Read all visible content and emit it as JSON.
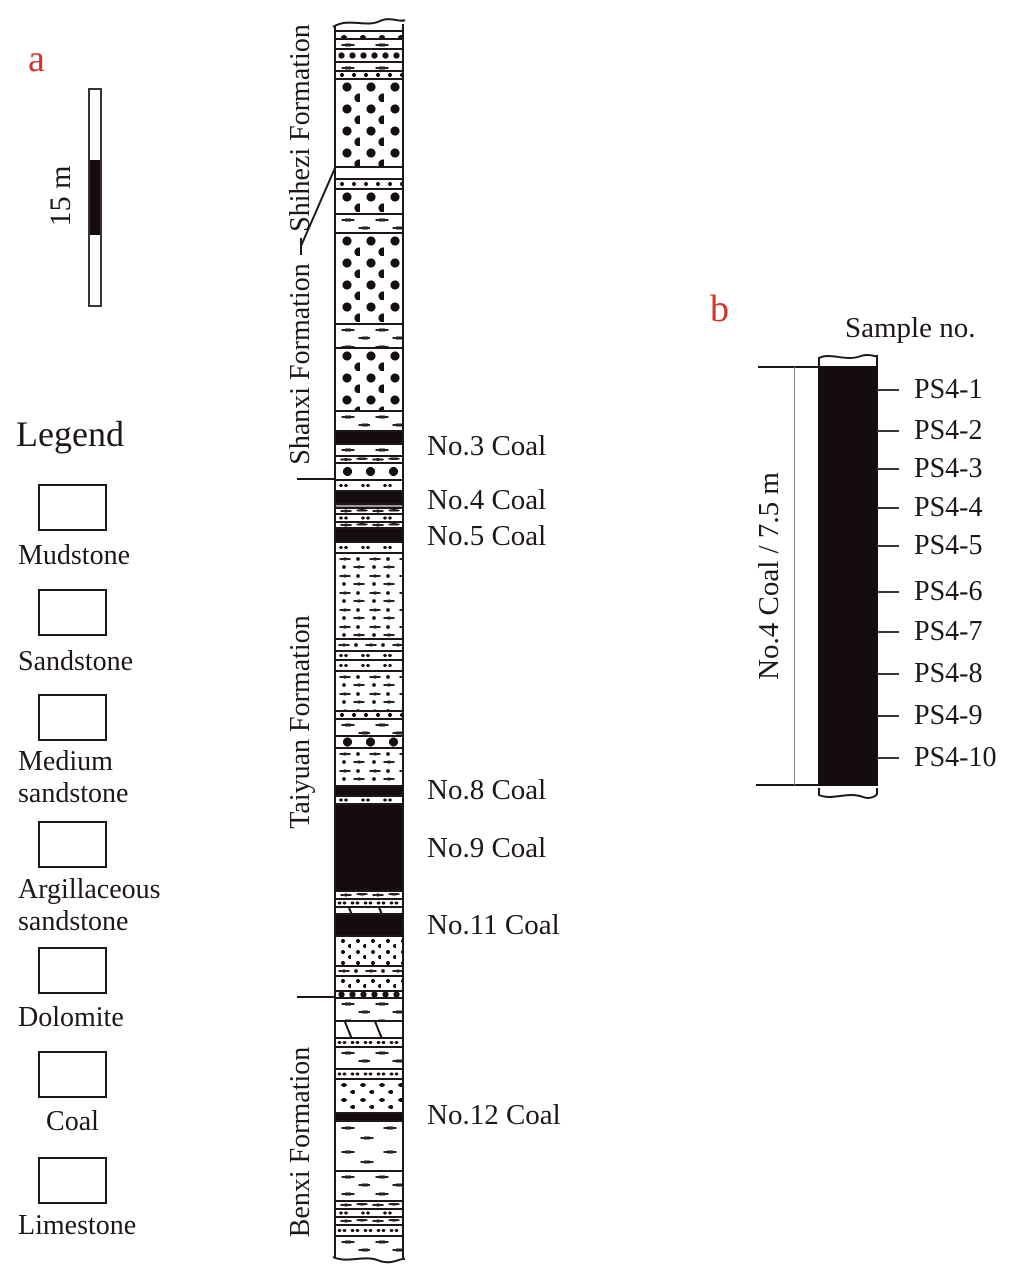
{
  "meta": {
    "ink_color": "#1f1717",
    "coal_color": "#150d0d",
    "accent_red": "#d5342b",
    "gray_band_color": "#9c9c9c"
  },
  "panel_a": {
    "label": "a",
    "scale": {
      "label": "15 m"
    },
    "legend": {
      "title": "Legend",
      "items": [
        {
          "name": "mudstone",
          "pattern": "mud",
          "lines": [
            "Mudstone"
          ],
          "box_y": 484,
          "label_y": 540
        },
        {
          "name": "sandstone",
          "pattern": "sand",
          "lines": [
            "Sandstone"
          ],
          "box_y": 589,
          "label_y": 646
        },
        {
          "name": "medium-sandstone",
          "pattern": "med",
          "lines": [
            "Medium",
            "sandstone"
          ],
          "box_y": 694,
          "label_y": 746
        },
        {
          "name": "argillaceous-sandstone",
          "pattern": "arg",
          "lines": [
            "Argillaceous",
            "sandstone"
          ],
          "box_y": 821,
          "label_y": 874
        },
        {
          "name": "dolomite",
          "pattern": "dolo-sw",
          "lines": [
            "Dolomite"
          ],
          "box_y": 947,
          "label_y": 1002
        },
        {
          "name": "coal",
          "pattern": "coal",
          "lines": [
            "Coal"
          ],
          "box_y": 1051,
          "label_y": 1106,
          "center": true
        },
        {
          "name": "limestone",
          "pattern": "lime",
          "lines": [
            "Limestone"
          ],
          "box_y": 1157,
          "label_y": 1210
        }
      ]
    }
  },
  "column": {
    "formations": [
      {
        "name": "Shihezi Formation",
        "cx": 301,
        "cy": 128,
        "len": 236
      },
      {
        "name": "Shanxi Formation",
        "cx": 301,
        "cy": 364,
        "len": 228
      },
      {
        "name": "Taiyuan Formation",
        "cx": 301,
        "cy": 722,
        "len": 256
      },
      {
        "name": "Benxi Formation",
        "cx": 301,
        "cy": 1142,
        "len": 250
      }
    ],
    "boundary_ticks_y": [
      478,
      996
    ],
    "layers": [
      {
        "p": "boxes",
        "h": 8
      },
      {
        "p": "mud",
        "h": 10
      },
      {
        "p": "dotrow",
        "h": 13
      },
      {
        "p": "mud",
        "h": 9
      },
      {
        "p": "med1",
        "h": 8
      },
      {
        "p": "sand",
        "h": 88
      },
      {
        "p": "blank",
        "h": 12
      },
      {
        "p": "med1",
        "h": 10
      },
      {
        "p": "sand",
        "h": 25
      },
      {
        "p": "mud",
        "h": 19
      },
      {
        "p": "sand",
        "h": 91
      },
      {
        "p": "mud",
        "h": 24
      },
      {
        "p": "sand",
        "h": 63
      },
      {
        "p": "mud",
        "h": 20
      },
      {
        "p": "coal",
        "h": 13
      },
      {
        "p": "mud",
        "h": 12
      },
      {
        "p": "mud-thin",
        "h": 7
      },
      {
        "p": "sand1",
        "h": 17
      },
      {
        "p": "oo",
        "h": 11
      },
      {
        "p": "coal",
        "h": 13
      },
      {
        "p": "gray",
        "h": 4
      },
      {
        "p": "mud-thin",
        "h": 6
      },
      {
        "p": "oo",
        "h": 8
      },
      {
        "p": "mud-thin",
        "h": 6
      },
      {
        "p": "coal",
        "h": 14
      },
      {
        "p": "oo",
        "h": 11
      },
      {
        "p": "arg",
        "h": 86
      },
      {
        "p": "arg-thin",
        "h": 12
      },
      {
        "p": "oo",
        "h": 9
      },
      {
        "p": "oo",
        "h": 11
      },
      {
        "p": "arg",
        "h": 40
      },
      {
        "p": "med1",
        "h": 8
      },
      {
        "p": "mud",
        "h": 17
      },
      {
        "p": "sand1",
        "h": 12
      },
      {
        "p": "arg",
        "h": 38
      },
      {
        "p": "coal",
        "h": 10
      },
      {
        "p": "oo",
        "h": 8
      },
      {
        "p": "coal",
        "h": 87
      },
      {
        "p": "mud-thin",
        "h": 8
      },
      {
        "p": "oo-dense",
        "h": 8
      },
      {
        "p": "dolo",
        "h": 7
      },
      {
        "p": "coal",
        "h": 22
      },
      {
        "p": "med",
        "h": 30
      },
      {
        "p": "arg-thin",
        "h": 10
      },
      {
        "p": "med",
        "h": 15
      },
      {
        "p": "dotrow",
        "h": 7
      },
      {
        "p": "mud",
        "h": 23
      },
      {
        "p": "dolo",
        "h": 17
      },
      {
        "p": "oo-dense",
        "h": 9
      },
      {
        "p": "mud",
        "h": 22
      },
      {
        "p": "oo-dense",
        "h": 10
      },
      {
        "p": "boxes",
        "h": 34
      },
      {
        "p": "coal",
        "h": 8
      },
      {
        "p": "mud-sparse",
        "h": 50
      },
      {
        "p": "mud",
        "h": 30
      },
      {
        "p": "mud-thin",
        "h": 8
      },
      {
        "p": "oo",
        "h": 8
      },
      {
        "p": "mud-thin",
        "h": 8
      },
      {
        "p": "oo-dense",
        "h": 11
      },
      {
        "p": "mud",
        "h": 21
      }
    ],
    "coal_labels": [
      {
        "text": "No.3 Coal",
        "y": 446
      },
      {
        "text": "No.4 Coal",
        "y": 500
      },
      {
        "text": "No.5 Coal",
        "y": 536
      },
      {
        "text": "No.8 Coal",
        "y": 790
      },
      {
        "text": "No.9 Coal",
        "y": 848
      },
      {
        "text": "No.11 Coal",
        "y": 925
      },
      {
        "text": "No.12 Coal",
        "y": 1115
      }
    ]
  },
  "panel_b": {
    "label": "b",
    "header": "Sample no.",
    "seam_label": "No.4 Coal / 7.5 m",
    "samples": [
      {
        "name": "PS4-1",
        "y": 390
      },
      {
        "name": "PS4-2",
        "y": 431
      },
      {
        "name": "PS4-3",
        "y": 469
      },
      {
        "name": "PS4-4",
        "y": 508
      },
      {
        "name": "PS4-5",
        "y": 546
      },
      {
        "name": "PS4-6",
        "y": 592
      },
      {
        "name": "PS4-7",
        "y": 632
      },
      {
        "name": "PS4-8",
        "y": 674
      },
      {
        "name": "PS4-9",
        "y": 716
      },
      {
        "name": "PS4-10",
        "y": 758
      }
    ]
  }
}
